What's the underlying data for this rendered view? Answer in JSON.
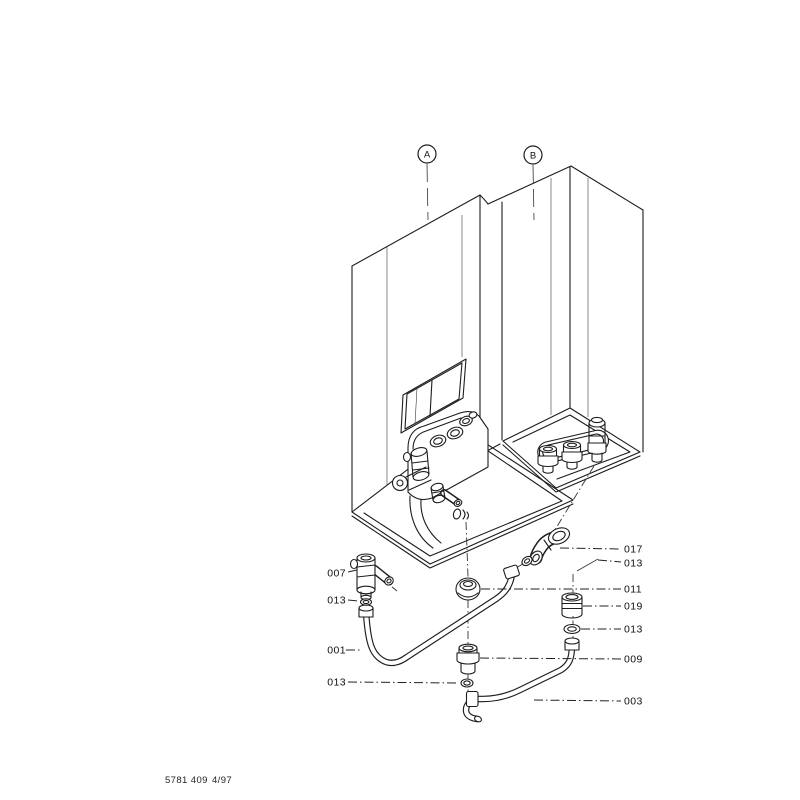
{
  "page": {
    "background": "#ffffff",
    "line_color": "#1d1d1d",
    "label_color": "#111111"
  },
  "markers": [
    {
      "id": "A",
      "label": "A"
    },
    {
      "id": "B",
      "label": "B"
    }
  ],
  "callouts": {
    "left": [
      {
        "id": "007",
        "label": "007"
      },
      {
        "id": "013-left-upper",
        "label": "013"
      },
      {
        "id": "001",
        "label": "001"
      },
      {
        "id": "013-left-lower",
        "label": "013"
      }
    ],
    "right": [
      {
        "id": "017",
        "label": "017"
      },
      {
        "id": "013-right-upper",
        "label": "013"
      },
      {
        "id": "011",
        "label": "011"
      },
      {
        "id": "019",
        "label": "019"
      },
      {
        "id": "013-right-middle",
        "label": "013"
      },
      {
        "id": "009",
        "label": "009"
      },
      {
        "id": "003",
        "label": "003"
      }
    ]
  },
  "footer": {
    "document_number": "5781 409",
    "edition": "4/97"
  }
}
